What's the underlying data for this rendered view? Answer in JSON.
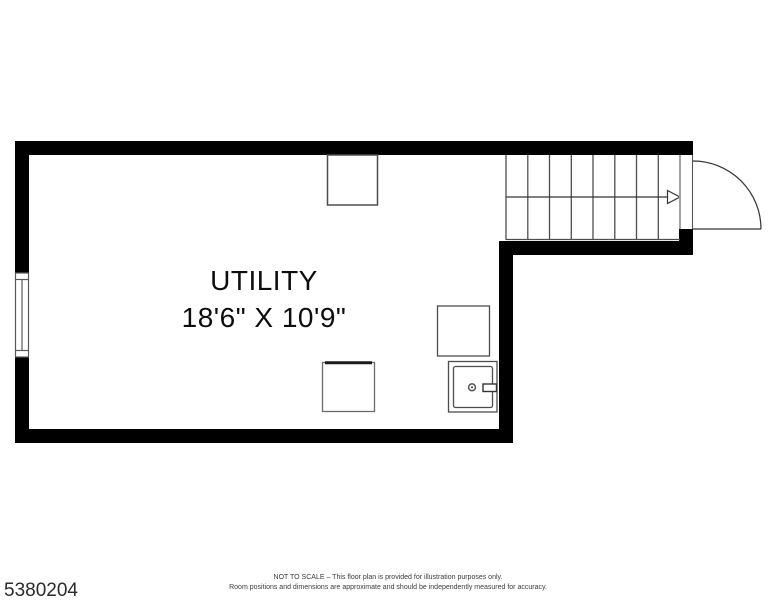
{
  "plan": {
    "room": {
      "name": "UTILITY",
      "dimensions": "18'6\" X 10'9\""
    },
    "elements": {
      "staircase": "staircase with 8 treads and up-direction arrow",
      "door": "door swinging out at top right",
      "window": "window on left wall",
      "fixtures": "three square fixtures and one water-heater unit"
    }
  },
  "footer": {
    "listing_id": "5380204",
    "disclaimer_line1": "NOT TO SCALE – This floor plan is provided for illustration purposes only.",
    "disclaimer_line2": "Room positions and dimensions are approximate and should be independently measured for accuracy."
  },
  "colors": {
    "wall": "#000000",
    "line": "#4d4d4d",
    "thin_line": "#333333",
    "text": "#0d0d0d"
  }
}
